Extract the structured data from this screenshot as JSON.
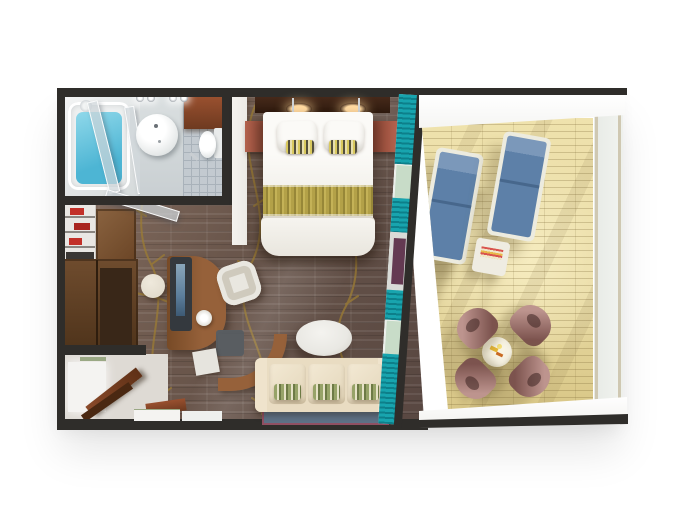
{
  "scene": {
    "kind": "3d-floorplan-render",
    "subject": "stateroom-suite-with-veranda",
    "background_is_blank_white": true,
    "rooms": {
      "bathroom": {
        "label": "bathroom",
        "fixtures": [
          "bathtub-with-water",
          "glass-shower-partition",
          "round-vanity-sink",
          "toilet",
          "open-wood-door",
          "ceiling-spotlights",
          "tiled-floor"
        ]
      },
      "closet": {
        "label": "walk-in-closet",
        "fixtures": [
          "shelf-unit-with-red-items",
          "wood-wardrobe"
        ]
      },
      "entry": {
        "label": "entry-hall",
        "fixtures": [
          "open-entry-door",
          "threshold"
        ]
      },
      "bedroom": {
        "label": "bedroom",
        "fixtures": [
          "headboard-with-lights",
          "double-bed",
          "two-pillows",
          "two-striped-accent-pillows",
          "gold-bed-runner",
          "nightstand-left",
          "nightstand-right",
          "patterned-carpet"
        ]
      },
      "living_area": {
        "label": "living-area",
        "fixtures": [
          "curved-desk",
          "monitor",
          "desk-chair",
          "ottoman-stool",
          "sofa-with-three-green-pillows",
          "oval-coffee-table",
          "blue-rug"
        ]
      },
      "curtain_wall": {
        "label": "glass-wall-with-teal-curtains",
        "fixtures": [
          "teal-curtains",
          "sliding-glass-door"
        ]
      },
      "balcony": {
        "label": "veranda",
        "fixtures": [
          "wood-deck",
          "two-blue-sun-loungers",
          "side-table",
          "round-dining-table",
          "four-mauve-chairs",
          "glass-railing",
          "white-overhang"
        ]
      }
    },
    "colors": {
      "bg": "#ffffff",
      "wall": "#2f2d2a",
      "carpet_base": "#6b574c",
      "carpet_streak_light": "#8a7264",
      "carpet_streak_dark": "#584741",
      "vine_gold": "#9c7c33",
      "bed_white": "#f2f0ea",
      "bed_shadow": "#d9d4c9",
      "pillow_white": "#fbfaf7",
      "runner_gold": "#b3a148",
      "runner_gold_dark": "#978738",
      "accent_stripe_dark": "#55503c",
      "accent_stripe_light": "#e8dfae",
      "headboard_wood": "#46291a",
      "light_glow": "#ffd9a0",
      "nightstand": "#b4634e",
      "nightstand_dark": "#8c4434",
      "white_wall": "#eceae5",
      "tile": "#c3cad0",
      "tile_line": "#a9b2ba",
      "bath_light_floor": "#d4d9da",
      "bath_white": "#eff1f1",
      "water_blue": "#4db5d4",
      "water_light": "#8fd8ea",
      "wood_door": "#99502f",
      "wood_door_dark": "#6e3a20",
      "chrome": "#c9ced2",
      "closet_wood": "#6f4c2e",
      "closet_wood_dark": "#4a3018",
      "closet_recess": "#392718",
      "shelf_white": "#e9e7e3",
      "shelf_red": "#c23028",
      "entry_floor": "#dedad4",
      "entry_bright": "#f4f3f1",
      "sage": "#9aa884",
      "desk_wood": "#96613a",
      "desk_wood_dark": "#774a26",
      "monitor_dark": "#34393e",
      "screen_blue": "#5d7f9c",
      "chair_white": "#e9e7e0",
      "chair_seat": "#cfcabd",
      "stool": "#ded7c8",
      "gray_panel": "#595d61",
      "sofa_base": "#e9dcc2",
      "sofa_cushion": "#f3e9d4",
      "sofa_arm": "#efe3cc",
      "pillow_green": "#97a368",
      "pillow_green_dark": "#6d7a45",
      "rug_blue": "#5e7186",
      "rug_border": "#904f62",
      "table_oval": "#e9e8e3",
      "teal": "#18a4ae",
      "teal_dark": "#0d7f8a",
      "glass": "#ccd6d3",
      "glass_green": "#c8dcc8",
      "door_purple": "#643a52",
      "silver": "#d9dbd7",
      "deck": "#e7d9a2",
      "deck_sun": "#f6ecc0",
      "deck_shadow": "rgba(115,98,58,0.32)",
      "overhang": "#f5f5f3",
      "railing": "#e6e9e4",
      "railing_post": "#cfc8b2",
      "ledge": "#f2f1ee",
      "lounger_frame": "#ecebdf",
      "lounger_blue": "#5d80a8",
      "lounger_blue_dark": "#47678c",
      "side_table": "#efece2",
      "dining_table": "#f4f0e2",
      "chair_mauve": "#bd948e",
      "chair_mauve_dark": "#7c534e"
    }
  }
}
